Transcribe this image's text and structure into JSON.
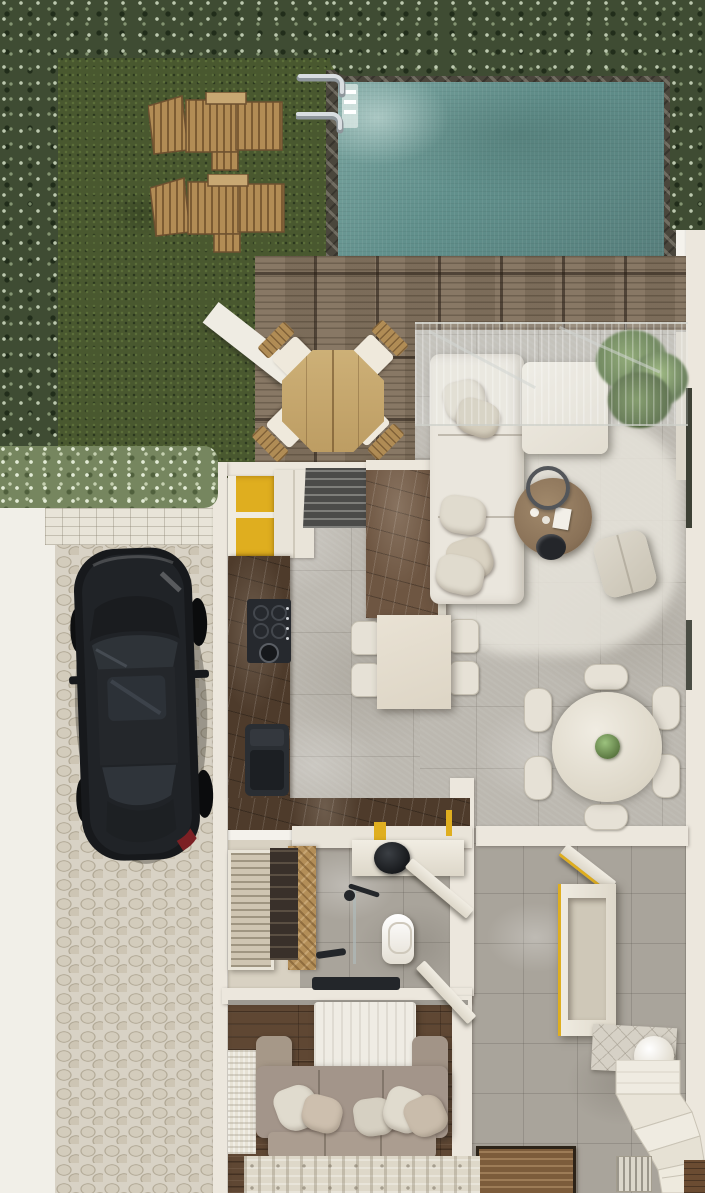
{
  "scene": {
    "description": "Top-down 3D rendered floor plan of a villa: walled garden with lawn and two sun loungers, rectangular swimming pool with ladder, wooden deck with octagonal outdoor dining set, open-plan living room with L-shaped cream sectional sofa, kitchen with mustard-yellow cabinets and dark marble counters, small dining table, round six-seat dining table, hallway with bench and curved staircase, bathroom with black vessel sink and walk-in shower, wardrobe closet, bedroom with bed and taupe sofa, and a black sedan parked on a cobblestone driveway.",
    "view": "orthographic top-down",
    "text_content": []
  },
  "regions": {
    "garden_lawn": "grass lawn",
    "hedge_border": "clipped hedge border",
    "swimming_pool": "swimming pool",
    "pool_deck": "timber deck tiles",
    "outdoor_dining": "octagonal teak table with four cushioned chairs",
    "living_room": "living room",
    "kitchen": "kitchen",
    "dining_nook": "four-seat dining table",
    "round_dining": "round six-seat dining table",
    "hallway": "entry hall",
    "bathroom": "bathroom with shower",
    "wardrobe": "wardrobe closet",
    "bedroom": "bedroom / tv lounge",
    "staircase": "winder staircase",
    "driveway": "cobblestone driveway with parked car",
    "sidewalk": "side path"
  },
  "objects": [
    {
      "name": "sun-lounger",
      "label": "wooden sun lounger",
      "count": 2
    },
    {
      "name": "pool-ladder",
      "label": "chrome pool ladder"
    },
    {
      "name": "outdoor-table",
      "label": "octagonal wooden table"
    },
    {
      "name": "outdoor-chair",
      "label": "folding chair with white cushion",
      "count": 4
    },
    {
      "name": "pergola-glass",
      "label": "glass canopy"
    },
    {
      "name": "sectional-sofa",
      "label": "L-shaped cream sectional sofa"
    },
    {
      "name": "coffee-table",
      "label": "round wooden coffee table"
    },
    {
      "name": "ottoman",
      "label": "cream pouf"
    },
    {
      "name": "potted-plant",
      "label": "potted plant"
    },
    {
      "name": "kitchen-cabinets",
      "label": "mustard yellow cabinets"
    },
    {
      "name": "cooktop",
      "label": "black gas cooktop"
    },
    {
      "name": "kitchen-sink",
      "label": "dark undermount sink"
    },
    {
      "name": "kitchen-island",
      "label": "marble-topped island"
    },
    {
      "name": "step-bench",
      "label": "dark slatted steps"
    },
    {
      "name": "dining-table",
      "label": "rectangular dining table"
    },
    {
      "name": "round-table",
      "label": "round dining table with plant centerpiece"
    },
    {
      "name": "hall-bench",
      "label": "cream console bench"
    },
    {
      "name": "sphere-lamp",
      "label": "white globe floor lamp"
    },
    {
      "name": "stairs",
      "label": "curved staircase"
    },
    {
      "name": "toilet",
      "label": "toilet"
    },
    {
      "name": "washbasin",
      "label": "black round vessel basin"
    },
    {
      "name": "shower",
      "label": "walk-in shower"
    },
    {
      "name": "herringbone-wall",
      "label": "herringbone wood feature wall"
    },
    {
      "name": "wardrobe",
      "label": "slatted wardrobe"
    },
    {
      "name": "tv",
      "label": "wall-mounted tv"
    },
    {
      "name": "bed",
      "label": "bed with cream duvet"
    },
    {
      "name": "bedroom-sofa",
      "label": "taupe sofa with throw pillows"
    },
    {
      "name": "area-rug",
      "label": "striped woven rug"
    },
    {
      "name": "car",
      "label": "black sedan"
    },
    {
      "name": "doormat",
      "label": "timber doormat"
    }
  ],
  "colors": {
    "hedge_dark": "#3f4c33",
    "hedge_light": "#76865f",
    "grass": "#49582f",
    "pool_water": "#61908c",
    "pool_border": "#4a463c",
    "deck_wood": "#83735f",
    "cobble": "#d8d2c5",
    "sidewalk": "#f1efe8",
    "wall": "#ece7dd",
    "floor_marble": "#bcb8b0",
    "rug_living": "#e7e4db",
    "counter_marble": "#4e3b2b",
    "cabinet_yellow": "#dfae1f",
    "sofa_cream": "#eae6dd",
    "sofa_taupe": "#a3958a",
    "wood_floor": "#5f4733",
    "herringbone": "#b38e58",
    "car_body": "#17191c",
    "fixture_black": "#23262a",
    "plant_green": "#55713f"
  }
}
